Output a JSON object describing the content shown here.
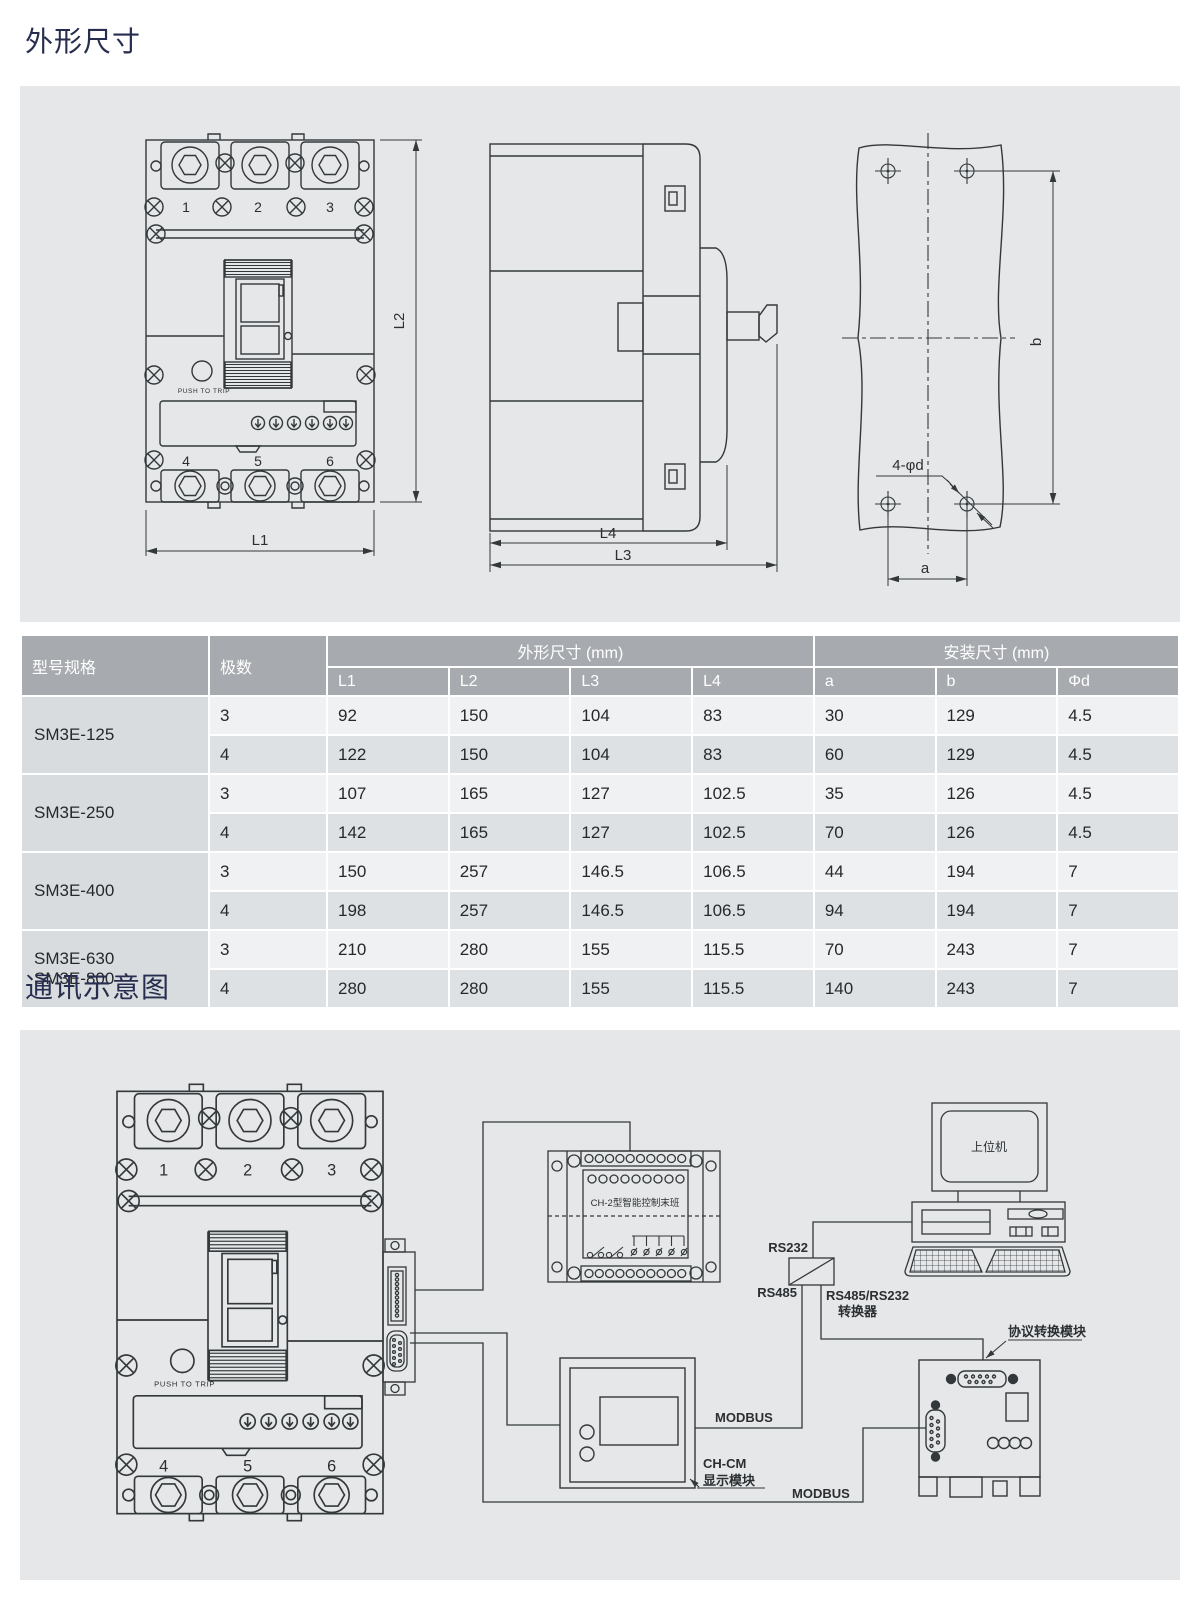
{
  "page": {
    "bg": "#ffffff",
    "panel_bg": "#e5e7e8",
    "line_color": "#33383b",
    "heading_color": "#272d4e",
    "table_header_bg": "#a7abaf",
    "table_row_light": "#eff1f2",
    "table_row_dark": "#dee1e3",
    "table_model_bg": "#d9dcde"
  },
  "sections": {
    "dimensions_title": "外形尺寸",
    "communication_title": "通讯示意图"
  },
  "front_view": {
    "terminals_top": [
      "1",
      "2",
      "3"
    ],
    "terminals_bottom": [
      "4",
      "5",
      "6"
    ],
    "push_to_trip": "PUSH TO TRIP",
    "dim_l1": "L1",
    "dim_l2": "L2"
  },
  "side_view": {
    "dim_l4": "L4",
    "dim_l3": "L3"
  },
  "mount_view": {
    "holes_label": "4-φd",
    "dim_a": "a",
    "dim_b": "b"
  },
  "table": {
    "col_model": "型号规格",
    "col_poles": "极数",
    "group_outline": "外形尺寸 (mm)",
    "group_mount": "安装尺寸 (mm)",
    "outline_cols": [
      "L1",
      "L2",
      "L3",
      "L4"
    ],
    "mount_cols": [
      "a",
      "b",
      "Φd"
    ],
    "groups": [
      {
        "model": [
          "SM3E-125"
        ],
        "rows": [
          [
            "3",
            "92",
            "150",
            "104",
            "83",
            "30",
            "129",
            "4.5"
          ],
          [
            "4",
            "122",
            "150",
            "104",
            "83",
            "60",
            "129",
            "4.5"
          ]
        ]
      },
      {
        "model": [
          "SM3E-250"
        ],
        "rows": [
          [
            "3",
            "107",
            "165",
            "127",
            "102.5",
            "35",
            "126",
            "4.5"
          ],
          [
            "4",
            "142",
            "165",
            "127",
            "102.5",
            "70",
            "126",
            "4.5"
          ]
        ]
      },
      {
        "model": [
          "SM3E-400"
        ],
        "rows": [
          [
            "3",
            "150",
            "257",
            "146.5",
            "106.5",
            "44",
            "194",
            "7"
          ],
          [
            "4",
            "198",
            "257",
            "146.5",
            "106.5",
            "94",
            "194",
            "7"
          ]
        ]
      },
      {
        "model": [
          "SM3E-630",
          "SM3E-800"
        ],
        "rows": [
          [
            "3",
            "210",
            "280",
            "155",
            "115.5",
            "70",
            "243",
            "7"
          ],
          [
            "4",
            "280",
            "280",
            "155",
            "115.5",
            "140",
            "243",
            "7"
          ]
        ]
      }
    ]
  },
  "diagram": {
    "ch2_label": "CH-2型智能控制末班",
    "host_label": "上位机",
    "rs232": "RS232",
    "rs485": "RS485",
    "converter_line1": "RS485/RS232",
    "converter_line2": "转换器",
    "modbus_display": "MODBUS",
    "modbus_bottom": "MODBUS",
    "chcm_line1": "CH-CM",
    "chcm_line2": "显示模块",
    "protocol_label": "协议转换模块"
  }
}
